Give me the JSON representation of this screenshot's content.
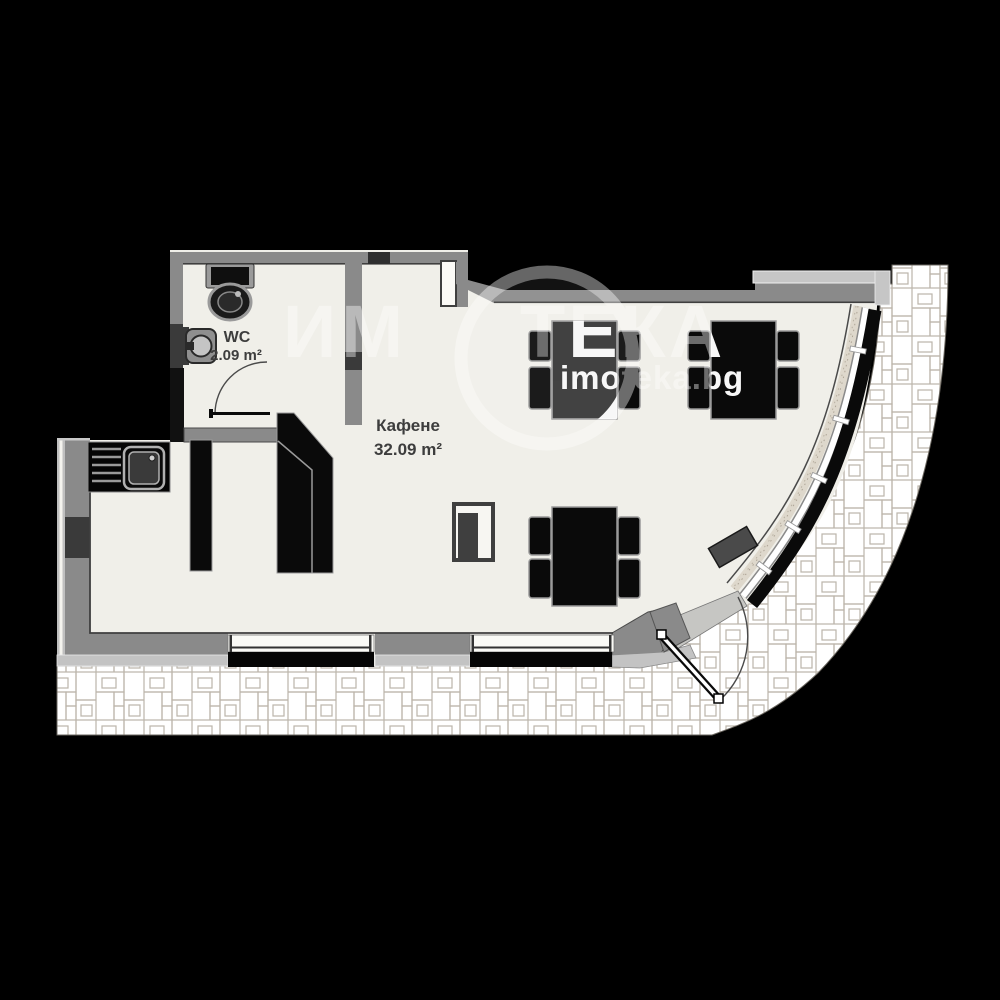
{
  "floor_plan": {
    "wc": {
      "name": "WC",
      "area": "2.09 m²"
    },
    "cafe": {
      "name": "Кафене",
      "area": "32.09 m²"
    }
  },
  "watermark": {
    "brand_left": "ИМ",
    "brand_right": "ТЕКА",
    "website": "imoteka.bg"
  },
  "icons": {
    "toilet": "toilet-icon",
    "washbasin": "washbasin-icon",
    "kitchen_sink": "kitchen-sink-icon",
    "wc_door": "wc-door-swing-icon",
    "entrance_door": "entrance-door-swing-icon",
    "dining_table": "dining-table-icon",
    "service_station": "service-station-icon"
  },
  "colors": {
    "background": "#000000",
    "floor": "#f0efe9",
    "wall": "#8a8a8a",
    "wall_dark": "#3a3a3a",
    "ledge": "#c6c6c6",
    "furniture_black": "#0a0a0a",
    "glazing_band": "#ded8cc",
    "paving_joint": "#bcb5aa",
    "label_text": "#3d3d3d",
    "watermark": "#ffffff"
  }
}
